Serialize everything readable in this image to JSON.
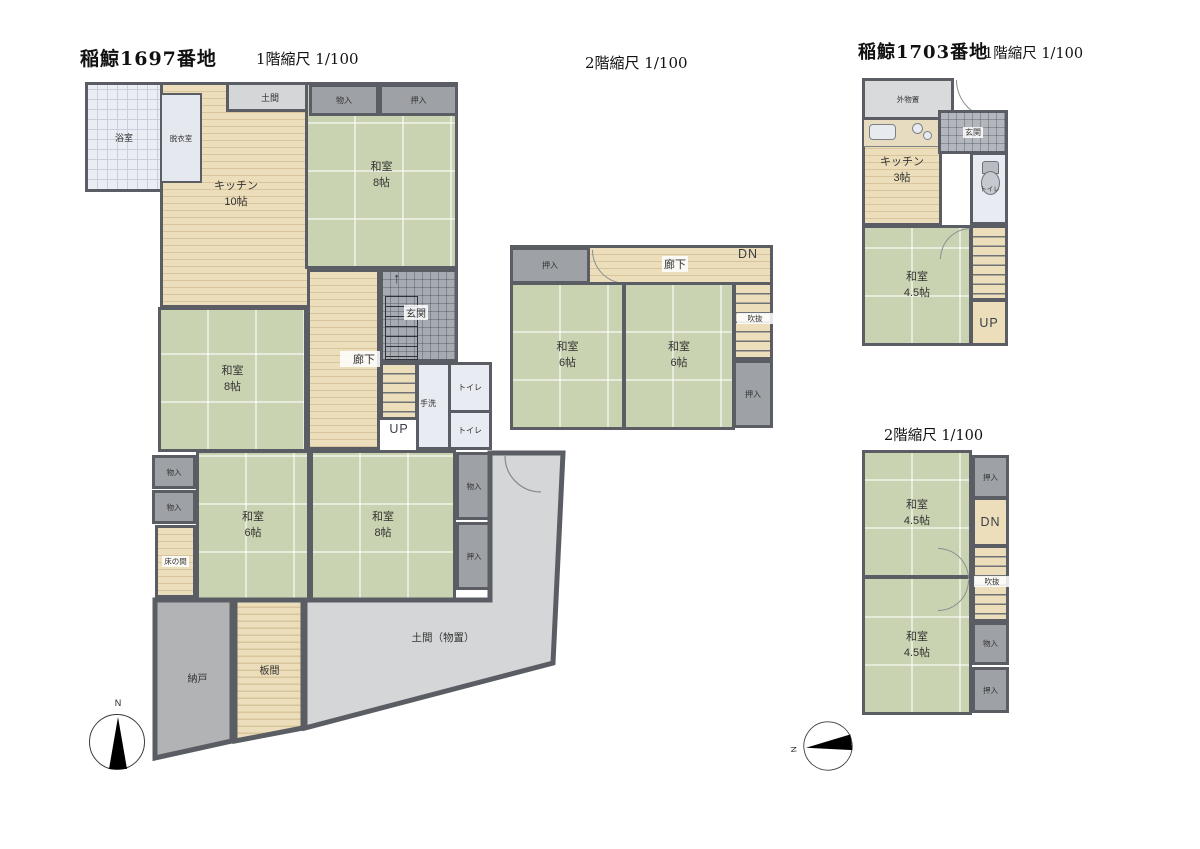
{
  "document": {
    "type": "japanese-floor-plan-sheet",
    "properties": [
      {
        "address": "稲鯨1697番地",
        "floors": [
          "1階",
          "2階"
        ]
      },
      {
        "address": "稲鯨1703番地",
        "floors": [
          "1階",
          "2階"
        ]
      }
    ]
  },
  "titles": {
    "p1697": "稲鯨1697番地",
    "p1697_f1_scale": "1階縮尺 1/100",
    "p1697_f2_scale": "2階縮尺 1/100",
    "p1703": "稲鯨1703番地",
    "p1703_f1_scale": "1階縮尺 1/100",
    "p1703_f2_scale": "2階縮尺 1/100"
  },
  "labels": {
    "bath": "浴室",
    "dressing": "脱衣室",
    "doma": "土間",
    "kitchen": "キッチン",
    "size10": "10帖",
    "size8": "8帖",
    "size6": "6帖",
    "size45": "4.5帖",
    "size3": "3帖",
    "washitsu": "和室",
    "monoiri": "物入",
    "oshiire": "押入",
    "genkan": "玄関",
    "rouka": "廊下",
    "up": "UP",
    "dn": "DN",
    "tearai": "手洗",
    "toilet": "トイレ",
    "tokonoma": "床の間",
    "nando": "納戸",
    "itama": "板間",
    "doma_storage": "土間（物置）",
    "fukinuke": "吹抜",
    "soto_monooki": "外物置",
    "north": "N"
  },
  "colors": {
    "wall": "#5a5e64",
    "tatami_green": "#c9d3b1",
    "wood_beige": "#ecdebb",
    "wood_stripe": "#d9c59d",
    "closet_gray": "#9ea1a6",
    "light_gray": "#d9dadb",
    "doma_gray": "#d5d6d7",
    "genkan_tile": "#a6abb2",
    "bath_tile": "#eaeef4",
    "white_room": "#e9ebf2",
    "compass_needle": "#000000"
  }
}
